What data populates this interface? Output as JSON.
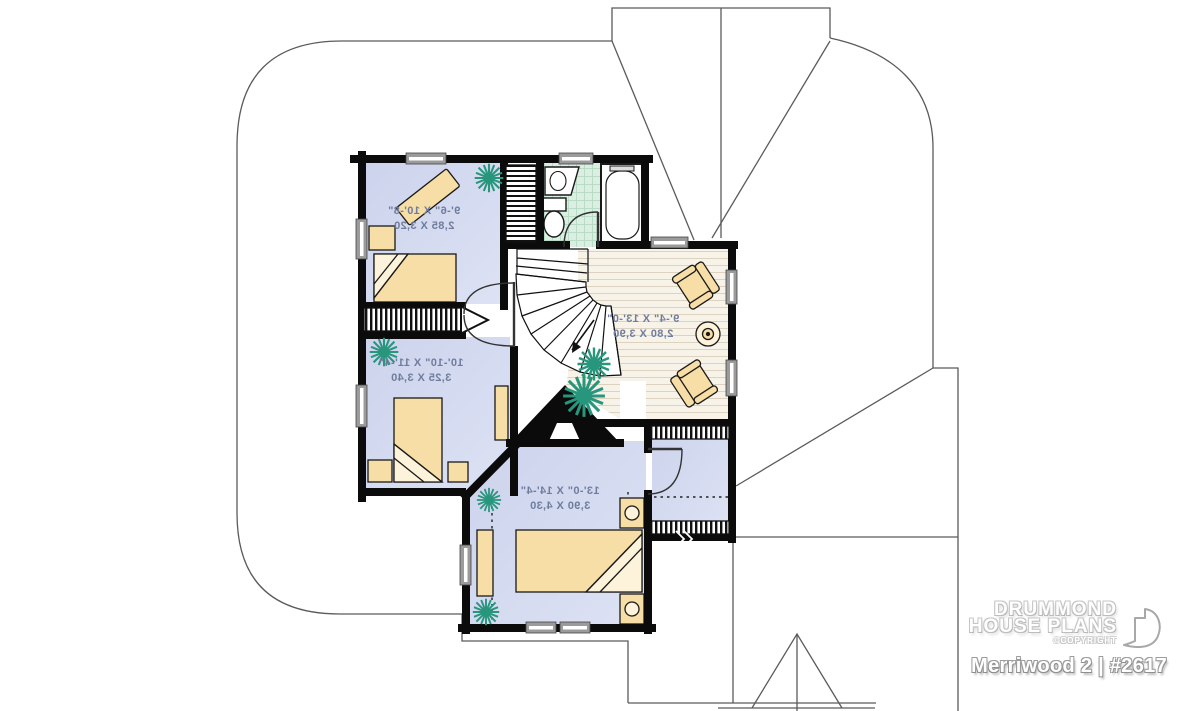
{
  "plan": {
    "rooms": [
      {
        "name": "bedroom-1",
        "imperial": "9'-6\" X 10'-8\"",
        "metric": "2,85 X 3,20"
      },
      {
        "name": "bedroom-2",
        "imperial": "10'-10\" X 11'-4\"",
        "metric": "3,25 X 3,40"
      },
      {
        "name": "master-bedroom",
        "imperial": "13'-0\" X 14'-4\"",
        "metric": "3,90 X 4,30"
      },
      {
        "name": "sitting-area",
        "imperial": "9'-4\" X 13'-0\"",
        "metric": "2,80 X 3,90"
      }
    ],
    "text_mirrored": true
  },
  "title_block": {
    "brand_line1": "DRUMMOND",
    "brand_line2": "HOUSE PLANS",
    "copyright": "©COPYRIGHT",
    "plan_title": "Merriwood 2 | #2617"
  },
  "colors": {
    "wall": "#0b0b0b",
    "bedroom-floor": "#ccd3ec",
    "bedroom-floor-light": "#dde2f4",
    "wood-base": "#f8f3e9",
    "wood-line": "#dcd2bf",
    "tile-base": "#daeee1",
    "tile-line": "#b9dcc6",
    "furniture": "#f7dda6",
    "furniture-light": "#fdf2da",
    "plant": "#27967c",
    "window-grey": "#9b9b9b",
    "roof-line": "#5b5b5b",
    "label": "#6f7d9d",
    "arc": "#333333"
  }
}
